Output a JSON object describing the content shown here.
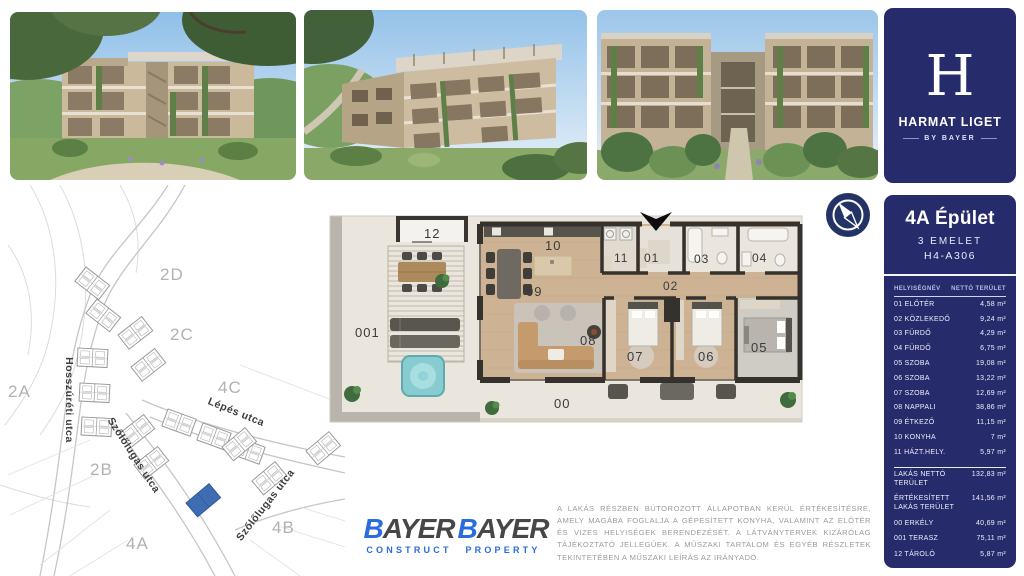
{
  "brand": {
    "letter": "H",
    "title": "HARMAT LIGET",
    "subtitle": "BY BAYER"
  },
  "unit_panel": {
    "building": "4A Épület",
    "floor": "3 EMELET",
    "unit_code": "H4-A306",
    "columns": {
      "name": "HELYISÉGNÉV",
      "area": "NETTÓ TERÜLET"
    },
    "rooms": [
      {
        "name": "01 ELŐTÉR",
        "area": "4,58 m²"
      },
      {
        "name": "02 KÖZLEKEDŐ",
        "area": "9,24 m²"
      },
      {
        "name": "03 FÜRDŐ",
        "area": "4,29 m²"
      },
      {
        "name": "04 FÜRDŐ",
        "area": "6,75 m²"
      },
      {
        "name": "05 SZOBA",
        "area": "19,08 m²"
      },
      {
        "name": "06 SZOBA",
        "area": "13,22 m²"
      },
      {
        "name": "07 SZOBA",
        "area": "12,69 m²"
      },
      {
        "name": "08 NAPPALI",
        "area": "38,86 m²"
      },
      {
        "name": "09 ÉTKEZŐ",
        "area": "11,15 m²"
      },
      {
        "name": "10 KONYHA",
        "area": "7 m²"
      },
      {
        "name": "11 HÁZT.HELY.",
        "area": "5,97 m²"
      }
    ],
    "summary": [
      {
        "name": "LAKÁS NETTÓ TERÜLET",
        "area": "132,83 m²"
      },
      {
        "name": "ÉRTÉKESÍTETT LAKÁS TERÜLET",
        "area": "141,56 m²"
      },
      {
        "name": "00 ERKÉLY",
        "area": "40,69 m²"
      },
      {
        "name": "001 TERASZ",
        "area": "75,11 m²"
      },
      {
        "name": "12 TÁROLÓ",
        "area": "5,87 m²"
      }
    ]
  },
  "site_map": {
    "areas": [
      "2D",
      "2C",
      "2A",
      "4C",
      "2B",
      "4A",
      "4B"
    ],
    "streets": [
      "Hosszúréti utca",
      "Lépés utca",
      "Szőlőlugas utca",
      "Szőlőlugas utca"
    ],
    "highlight_color": "#3f6db4"
  },
  "floor_plan": {
    "room_labels": [
      "12",
      "10",
      "09",
      "11",
      "01",
      "02",
      "03",
      "04",
      "08",
      "07",
      "06",
      "05",
      "001",
      "00"
    ]
  },
  "footer": {
    "logos": [
      {
        "b": "B",
        "rest": "AYER",
        "sub": "CONSTRUCT"
      },
      {
        "b": "B",
        "rest": "AYER",
        "sub": "PROPERTY"
      }
    ],
    "disclaimer": "A LAKÁS RÉSZBEN BÚTOROZOTT ÁLLAPOTBAN KERÜL ÉRTÉKESÍTÉSRE, AMELY MAGÁBA FOGLALJA A GÉPESÍTETT KONYHA, VALAMINT AZ ELŐTÉR ÉS VIZES HELYISÉGEK BERENDEZÉSÉT. A LÁTVÁNYTERVEK KIZÁRÓLAG TÁJÉKOZTATÓ JELLEGŰEK. A MŰSZAKI TARTALOM ÉS EGYÉB RÉSZLETEK TEKINTETÉBEN A MŰSZAKI LEÍRÁS AZ IRÁNYADÓ."
  },
  "colors": {
    "navy": "#262b6b",
    "logo_blue": "#2a6be0",
    "map_highlight": "#3f6db4"
  }
}
